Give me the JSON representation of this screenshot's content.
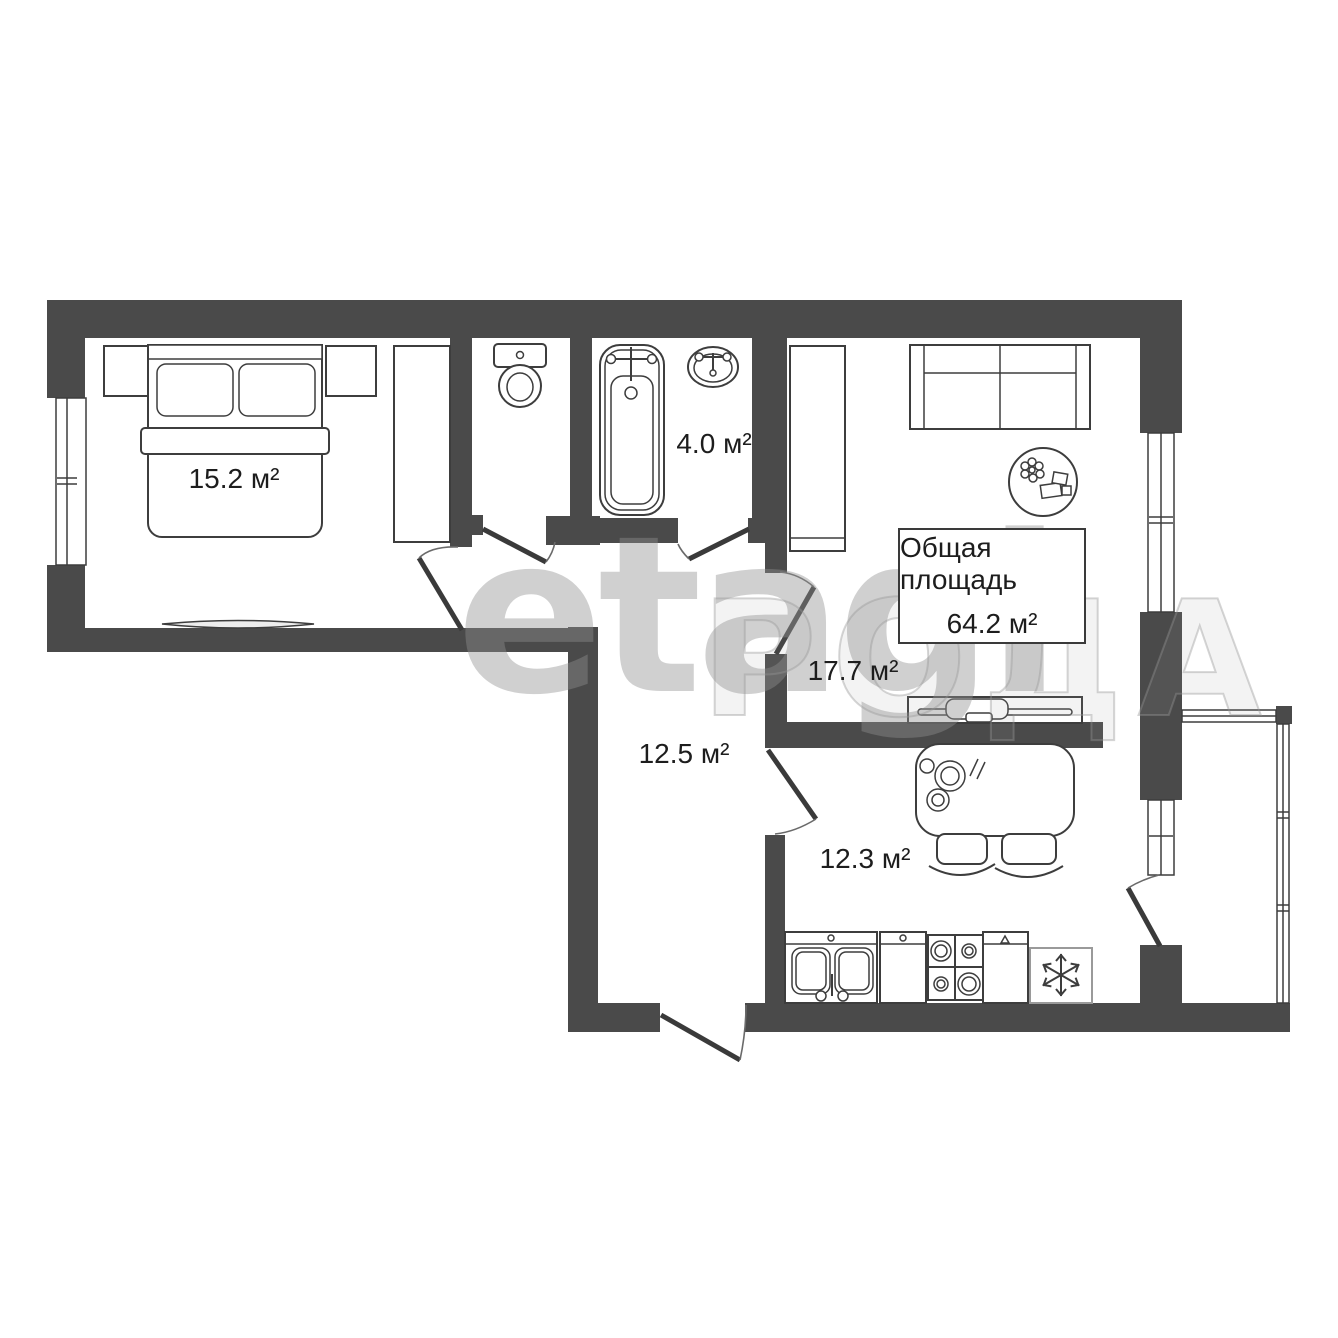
{
  "plan": {
    "colors": {
      "wall": "#4a4a4a",
      "line": "#3d3d3d",
      "text": "#1d1d1d",
      "watermark": "#909090"
    },
    "watermark_primary": "etagi",
    "watermark_secondary": "РОДА",
    "total_area": {
      "label": "Общая площадь",
      "value": "64.2 м²"
    },
    "rooms": [
      {
        "name": "bedroom",
        "area": "15.2 м²"
      },
      {
        "name": "bathroom",
        "area": "4.0 м²"
      },
      {
        "name": "living-room",
        "area": "17.7 м²"
      },
      {
        "name": "hallway",
        "area": "12.5 м²"
      },
      {
        "name": "kitchen",
        "area": "12.3 м²"
      }
    ]
  }
}
